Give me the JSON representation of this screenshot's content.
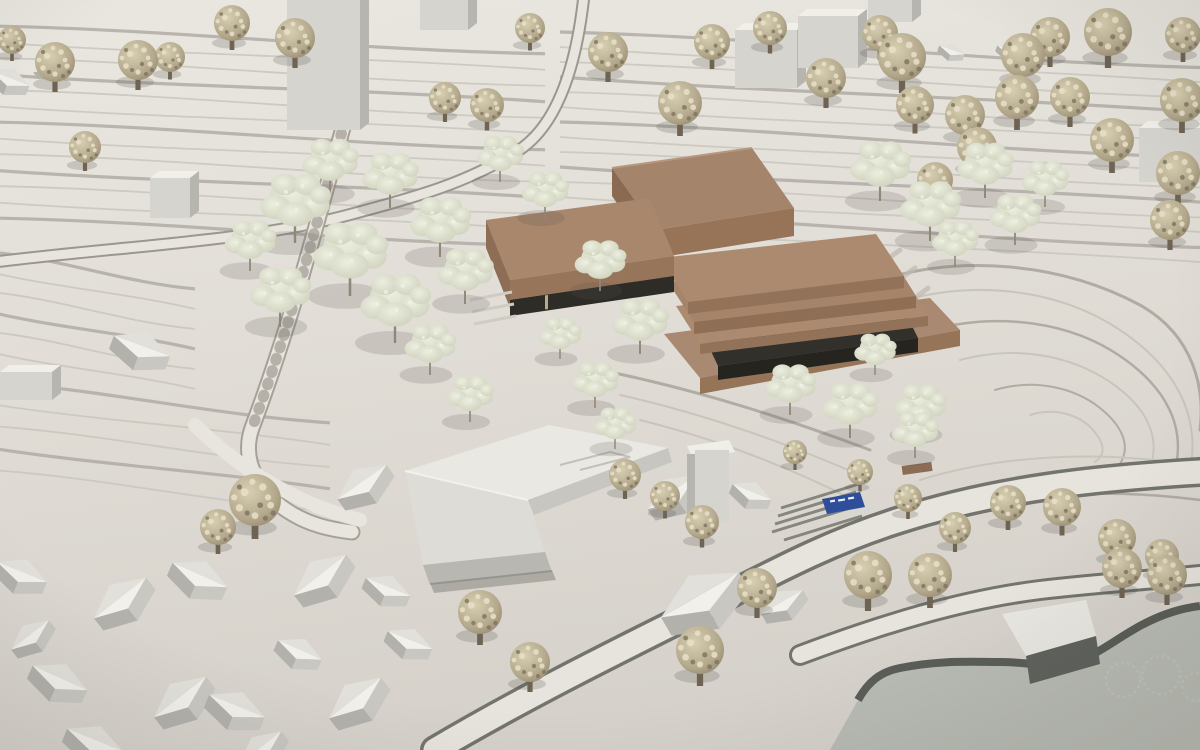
{
  "meta": {
    "title": "Architectural site model photograph",
    "subject": "white massing model with terraced terrain, tree canopy, village houses and a wooden museum building complex"
  },
  "palette": {
    "board_light": "#e9e6e0",
    "board_dark": "#d7d3cc",
    "contour_line": "#c9c5bd",
    "contour_wall": "#b0aca4",
    "road_fill": "#e8e5de",
    "road_edge": "#73746d",
    "roof_far": "#e2e0da",
    "roof_near": "#f1f0ea",
    "wall_left": "#b3b1ac",
    "wall_right": "#c9c7c1",
    "box_front": "#d6d4cf",
    "box_side": "#b7b5b0",
    "box_top": "#f0efe9",
    "brown_top": "#a5846c",
    "brown_side": "#8b6a52",
    "brown_front": "#977457",
    "brown_recess": "#2e2c27",
    "tree_puff_light": "#d2c9ac",
    "tree_puff_mid": "#b1a689",
    "tree_puff_dark": "#7e7460",
    "tree_leaf_light": "#e6e8da",
    "tree_leaf_mid": "#c9cdb8",
    "trunk": "#6f6353",
    "water_base": "#b9bcb4",
    "plate_edge": "#5b5e58",
    "sign_blue": "#2e4d9b"
  },
  "sign": {
    "color": "#2e4d9b",
    "text": ""
  },
  "scene": {
    "terrace_bands": [
      {
        "x0": -10,
        "x1": 545,
        "y": 26,
        "n": 13,
        "dy": 16,
        "slope": 0.05
      },
      {
        "x0": 560,
        "x1": 1210,
        "y": 32,
        "n": 14,
        "dy": 15,
        "slope": 0.055
      },
      {
        "x0": -10,
        "x1": 195,
        "y": 252,
        "n": 6,
        "dy": 20,
        "slope": 0.18
      },
      {
        "x0": -10,
        "x1": 330,
        "y": 382,
        "n": 5,
        "dy": 22,
        "slope": 0.12
      }
    ],
    "boxes": [
      [
        150,
        178,
        40,
        40
      ],
      [
        287,
        0,
        73,
        130
      ],
      [
        420,
        0,
        48,
        30
      ],
      [
        735,
        30,
        62,
        58
      ],
      [
        798,
        16,
        60,
        52
      ],
      [
        868,
        0,
        44,
        22
      ],
      [
        1139,
        128,
        61,
        54
      ],
      [
        0,
        372,
        52,
        28
      ]
    ],
    "houses": [
      [
        10,
        78,
        0.7,
        22
      ],
      [
        48,
        62,
        0.6,
        -35
      ],
      [
        142,
        346,
        1.0,
        20
      ],
      [
        362,
        482,
        1.0,
        -35
      ],
      [
        22,
        572,
        0.9,
        22
      ],
      [
        120,
        598,
        1.1,
        -38
      ],
      [
        200,
        575,
        1.0,
        24
      ],
      [
        320,
        575,
        1.1,
        -38
      ],
      [
        388,
        587,
        0.8,
        22
      ],
      [
        30,
        635,
        0.8,
        -38
      ],
      [
        300,
        650,
        0.8,
        24
      ],
      [
        60,
        678,
        1.0,
        24
      ],
      [
        180,
        697,
        1.1,
        -38
      ],
      [
        237,
        706,
        1.0,
        22
      ],
      [
        355,
        698,
        1.1,
        -38
      ],
      [
        410,
        640,
        0.8,
        22
      ],
      [
        95,
        740,
        1.0,
        22
      ],
      [
        260,
        748,
        0.9,
        -38
      ],
      [
        672,
        492,
        1.0,
        -35
      ],
      [
        752,
        492,
        0.7,
        22
      ],
      [
        700,
        595,
        1.5,
        -30
      ],
      [
        782,
        602,
        0.8,
        -30
      ],
      [
        952,
        50,
        0.45,
        20
      ],
      [
        1010,
        50,
        0.45,
        20
      ]
    ],
    "puff_trees": [
      [
        12,
        40,
        14
      ],
      [
        55,
        62,
        20
      ],
      [
        138,
        60,
        20
      ],
      [
        170,
        57,
        15
      ],
      [
        232,
        23,
        18
      ],
      [
        295,
        38,
        20
      ],
      [
        85,
        147,
        16
      ],
      [
        445,
        98,
        16
      ],
      [
        487,
        105,
        17
      ],
      [
        530,
        28,
        15
      ],
      [
        608,
        52,
        20
      ],
      [
        680,
        103,
        22
      ],
      [
        712,
        42,
        18
      ],
      [
        770,
        28,
        17
      ],
      [
        826,
        78,
        20
      ],
      [
        880,
        33,
        18
      ],
      [
        902,
        57,
        24
      ],
      [
        915,
        105,
        19
      ],
      [
        965,
        115,
        20
      ],
      [
        1017,
        97,
        22
      ],
      [
        1023,
        55,
        22
      ],
      [
        1050,
        37,
        20
      ],
      [
        1108,
        32,
        24
      ],
      [
        1183,
        35,
        18
      ],
      [
        1070,
        97,
        20
      ],
      [
        1182,
        100,
        22
      ],
      [
        977,
        147,
        20
      ],
      [
        1112,
        140,
        22
      ],
      [
        1178,
        173,
        22
      ],
      [
        1170,
        220,
        20
      ],
      [
        935,
        180,
        18
      ],
      [
        255,
        500,
        26
      ],
      [
        218,
        527,
        18
      ],
      [
        625,
        475,
        16
      ],
      [
        665,
        496,
        15
      ],
      [
        702,
        522,
        17
      ],
      [
        480,
        612,
        22
      ],
      [
        530,
        662,
        20
      ],
      [
        700,
        650,
        24
      ],
      [
        757,
        588,
        20
      ],
      [
        795,
        452,
        12
      ],
      [
        860,
        472,
        13
      ],
      [
        908,
        498,
        14
      ],
      [
        955,
        528,
        16
      ],
      [
        1008,
        503,
        18
      ],
      [
        1062,
        507,
        19
      ],
      [
        1117,
        538,
        19
      ],
      [
        1162,
        556,
        17
      ],
      [
        868,
        575,
        24
      ],
      [
        930,
        575,
        22
      ],
      [
        1122,
        568,
        20
      ],
      [
        1167,
        575,
        20
      ]
    ],
    "leaf_trees": [
      [
        330,
        158,
        1.2
      ],
      [
        295,
        198,
        1.5
      ],
      [
        350,
        248,
        1.6
      ],
      [
        280,
        288,
        1.3
      ],
      [
        395,
        298,
        1.5
      ],
      [
        440,
        218,
        1.3
      ],
      [
        465,
        268,
        1.2
      ],
      [
        250,
        238,
        1.1
      ],
      [
        390,
        172,
        1.2
      ],
      [
        430,
        342,
        1.1
      ],
      [
        470,
        392,
        1.0
      ],
      [
        500,
        152,
        1.0
      ],
      [
        545,
        188,
        1.0
      ],
      [
        600,
        258,
        1.1
      ],
      [
        640,
        318,
        1.2
      ],
      [
        595,
        378,
        1.0
      ],
      [
        615,
        422,
        0.9
      ],
      [
        560,
        332,
        0.9
      ],
      [
        790,
        382,
        1.1
      ],
      [
        850,
        402,
        1.2
      ],
      [
        915,
        428,
        1.0
      ],
      [
        875,
        348,
        0.9
      ],
      [
        920,
        402,
        1.1
      ],
      [
        880,
        162,
        1.3
      ],
      [
        930,
        202,
        1.3
      ],
      [
        985,
        162,
        1.2
      ],
      [
        1015,
        212,
        1.1
      ],
      [
        955,
        237,
        1.0
      ],
      [
        1045,
        177,
        1.0
      ]
    ],
    "ghost_circles": [
      [
        1123,
        680,
        17
      ],
      [
        1161,
        675,
        19
      ],
      [
        1196,
        687,
        14
      ]
    ]
  }
}
